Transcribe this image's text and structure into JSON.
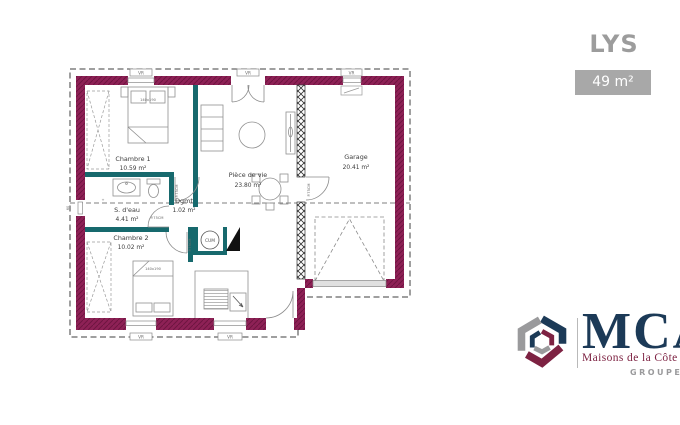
{
  "header": {
    "title": "LYS",
    "area_badge": "49 m²"
  },
  "plan": {
    "rooms": [
      {
        "name": "Chambre 1",
        "area": "10.59 m²"
      },
      {
        "name": "S. d'eau",
        "area": "4.41 m²"
      },
      {
        "name": "Dgmt",
        "area": "1.02 m²"
      },
      {
        "name": "Chambre 2",
        "area": "10.02 m²"
      },
      {
        "name": "Pièce de vie",
        "area": "23.80 m²"
      },
      {
        "name": "Garage",
        "area": "20.41 m²"
      }
    ],
    "annotations": {
      "shutter": "VR",
      "water_heater": "CUM",
      "door_size": "P.75CM",
      "bed_size": "140x190",
      "window_dim": "60",
      "plus_mark": "+"
    },
    "colors": {
      "wall": "#8e2156",
      "partition": "#17696d"
    }
  },
  "logo": {
    "brand": "MCA",
    "tagline": "Maisons de la Côte Atlantique",
    "group": "GROUPE HEXAOM",
    "colors": {
      "navy": "#1c3a57",
      "maroon": "#7d2242",
      "gray": "#9a9a9c"
    }
  }
}
